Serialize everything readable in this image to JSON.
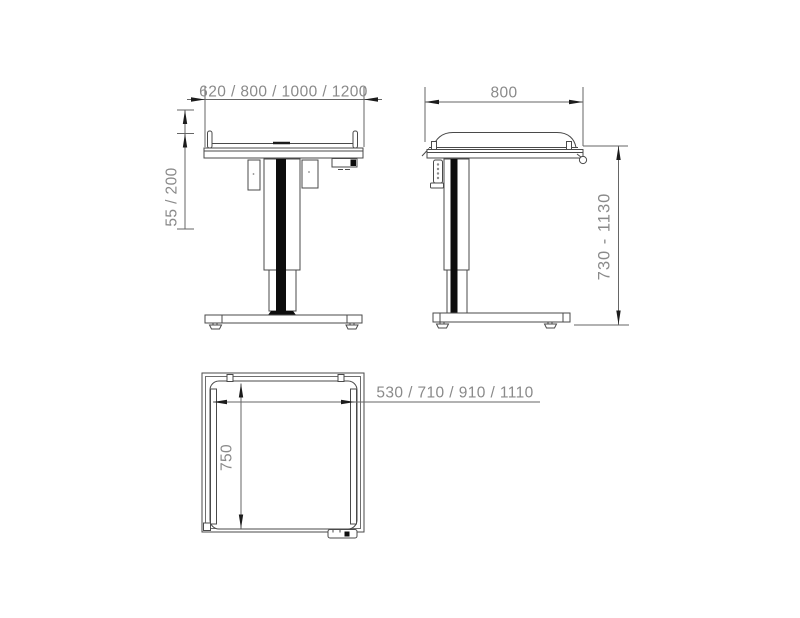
{
  "diagram": {
    "front": {
      "width_label": "620 / 800 / 1000 / 1200",
      "rail_height_label": "55 / 200"
    },
    "side": {
      "depth_label": "800",
      "height_range_label": "730 - 1130"
    },
    "top": {
      "inner_width_label": "530 / 710 / 910 / 1110",
      "inner_depth_label": "750"
    },
    "colors": {
      "background": "#ffffff",
      "outline": "#4a4a4a",
      "dimension_line": "#666666",
      "dimension_text": "#8a8a8a",
      "column_stripe": "#0d0d0d"
    }
  }
}
